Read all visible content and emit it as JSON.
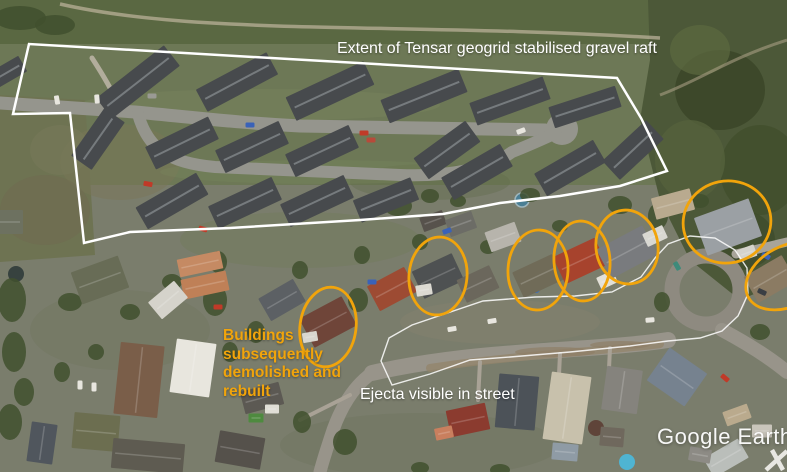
{
  "watermark": {
    "text": "Google Earth"
  },
  "annotations": {
    "colors": {
      "orange": "#F1A40B",
      "white": "#FFFFFF"
    },
    "geogrid": {
      "label": "Extent of Tensar geogrid stabilised gravel raft",
      "points": "29,44 13,114 70,113 84,243 130,232 230,228 360,220 443,214 500,203 560,196 620,186 667,171 641,118 617,78"
    },
    "ejecta": {
      "label": "Ejecta visible in street",
      "points": "381,361 389,338 412,325 483,301 535,297 575,296 612,292 641,277 655,258 668,244 690,236 715,238 735,250 747,268 748,294 738,316 722,331 700,338 668,341 630,346 570,352 510,357 470,360 430,374 392,385"
    },
    "demolished": {
      "lines": [
        "Buildings",
        "subsequently",
        "demolished and",
        "rebuilt"
      ],
      "ellipses": [
        {
          "cx": 328,
          "cy": 327,
          "rx": 28,
          "ry": 40,
          "rot": 8
        },
        {
          "cx": 438,
          "cy": 276,
          "rx": 29,
          "ry": 39,
          "rot": 5
        },
        {
          "cx": 538,
          "cy": 270,
          "rx": 30,
          "ry": 40,
          "rot": 3
        },
        {
          "cx": 582,
          "cy": 261,
          "rx": 28,
          "ry": 40,
          "rot": -4
        },
        {
          "cx": 627,
          "cy": 247,
          "rx": 31,
          "ry": 37,
          "rot": -8
        },
        {
          "cx": 727,
          "cy": 222,
          "rx": 44,
          "ry": 41,
          "rot": -12
        },
        {
          "cx": 788,
          "cy": 276,
          "rx": 45,
          "ry": 30,
          "rot": -28
        }
      ]
    }
  },
  "scene": {
    "subdivision_buildings": [
      [
        138,
        82,
        86,
        26,
        -38
      ],
      [
        237,
        82,
        80,
        25,
        -28
      ],
      [
        330,
        91,
        86,
        26,
        -25
      ],
      [
        424,
        96,
        84,
        25,
        -22
      ],
      [
        510,
        101,
        78,
        24,
        -20
      ],
      [
        585,
        107,
        70,
        22,
        -18
      ],
      [
        8,
        72,
        34,
        18,
        -30
      ],
      [
        98,
        139,
        58,
        25,
        -55
      ],
      [
        182,
        143,
        70,
        25,
        -26
      ],
      [
        252,
        147,
        70,
        25,
        -25
      ],
      [
        322,
        151,
        70,
        25,
        -25
      ],
      [
        447,
        150,
        64,
        26,
        -36
      ],
      [
        172,
        201,
        70,
        25,
        -30
      ],
      [
        245,
        203,
        70,
        25,
        -25
      ],
      [
        317,
        201,
        70,
        25,
        -25
      ],
      [
        386,
        200,
        62,
        24,
        -22
      ],
      [
        477,
        172,
        68,
        26,
        -30
      ],
      [
        570,
        168,
        68,
        26,
        -30
      ],
      [
        633,
        150,
        60,
        26,
        -43
      ]
    ],
    "suburb_buildings": [
      [
        8,
        222,
        30,
        24,
        0,
        "#6d7160"
      ],
      [
        100,
        280,
        50,
        34,
        -20,
        "#686c56"
      ],
      [
        200,
        264,
        44,
        18,
        -12,
        "#c58a63"
      ],
      [
        205,
        285,
        46,
        20,
        -12,
        "#bf8057"
      ],
      [
        168,
        300,
        34,
        22,
        -40,
        "#d5d3cb"
      ],
      [
        282,
        300,
        40,
        26,
        -30,
        "#5c6064"
      ],
      [
        328,
        322,
        48,
        33,
        -28,
        "#6f4539"
      ],
      [
        310,
        337,
        15,
        10,
        -10,
        "#d8d6ce"
      ],
      [
        392,
        289,
        42,
        28,
        -28,
        "#9d4b33"
      ],
      [
        433,
        221,
        24,
        15,
        -20,
        "#57524c"
      ],
      [
        461,
        224,
        28,
        18,
        -20,
        "#6c6c66"
      ],
      [
        503,
        237,
        32,
        21,
        -20,
        "#b7b4ac"
      ],
      [
        438,
        276,
        44,
        30,
        -25,
        "#4e5152"
      ],
      [
        424,
        290,
        16,
        11,
        -10,
        "#dcdad2"
      ],
      [
        478,
        284,
        36,
        25,
        -25,
        "#6b675c"
      ],
      [
        538,
        276,
        44,
        28,
        -25,
        "#706b58"
      ],
      [
        580,
        261,
        46,
        30,
        -25,
        "#a7432d"
      ],
      [
        607,
        280,
        18,
        13,
        -25,
        "#e2e0d8"
      ],
      [
        627,
        252,
        52,
        33,
        -28,
        "#797b7e"
      ],
      [
        655,
        236,
        22,
        14,
        -25,
        "#d9d8d2"
      ],
      [
        673,
        204,
        40,
        22,
        -15,
        "#b9aa8f"
      ],
      [
        728,
        227,
        58,
        40,
        -20,
        "#9ba0a4"
      ],
      [
        747,
        253,
        18,
        12,
        -20,
        "#d5d3cb"
      ],
      [
        770,
        279,
        44,
        30,
        -30,
        "#8b7b63"
      ],
      [
        139,
        380,
        44,
        72,
        6,
        "#7a5e49"
      ],
      [
        193,
        368,
        40,
        54,
        8,
        "#e8e6de"
      ],
      [
        96,
        432,
        46,
        36,
        5,
        "#6c6e50"
      ],
      [
        42,
        443,
        26,
        40,
        8,
        "#50565d"
      ],
      [
        148,
        456,
        72,
        30,
        5,
        "#5e5b51"
      ],
      [
        240,
        450,
        46,
        32,
        10,
        "#55514b"
      ],
      [
        262,
        398,
        40,
        23,
        -15,
        "#5c5953"
      ],
      [
        272,
        409,
        14,
        9,
        0,
        "#e0ded6"
      ],
      [
        256,
        418,
        15,
        9,
        0,
        "#4e8a3f"
      ],
      [
        468,
        420,
        40,
        27,
        -12,
        "#8b3b2f"
      ],
      [
        444,
        433,
        18,
        12,
        -12,
        "#c97f5e"
      ],
      [
        517,
        402,
        40,
        54,
        5,
        "#4c5258"
      ],
      [
        567,
        408,
        40,
        68,
        8,
        "#c8c1ac"
      ],
      [
        565,
        452,
        26,
        17,
        5,
        "#8f9ba5"
      ],
      [
        622,
        390,
        36,
        44,
        8,
        "#85837d"
      ],
      [
        612,
        437,
        24,
        19,
        5,
        "#6f685d"
      ],
      [
        677,
        377,
        46,
        40,
        35,
        "#76828f"
      ],
      [
        726,
        458,
        40,
        22,
        -30,
        "#babeba"
      ],
      [
        762,
        431,
        20,
        13,
        0,
        "#c9c5bb"
      ],
      [
        737,
        415,
        26,
        15,
        -20,
        "#baaa8d"
      ],
      [
        700,
        455,
        22,
        14,
        10,
        "#8d8b85"
      ]
    ],
    "trees": [
      [
        20,
        18,
        26,
        12
      ],
      [
        55,
        25,
        20,
        10
      ],
      [
        12,
        300,
        14,
        22
      ],
      [
        14,
        352,
        12,
        20
      ],
      [
        10,
        422,
        12,
        18
      ],
      [
        24,
        392,
        10,
        14
      ],
      [
        70,
        302,
        12,
        9
      ],
      [
        130,
        312,
        10,
        8
      ],
      [
        96,
        352,
        8,
        8
      ],
      [
        62,
        372,
        8,
        10
      ],
      [
        172,
        282,
        10,
        8
      ],
      [
        215,
        300,
        12,
        16
      ],
      [
        218,
        262,
        9,
        11
      ],
      [
        256,
        332,
        9,
        11
      ],
      [
        300,
        270,
        8,
        9
      ],
      [
        358,
        300,
        10,
        12
      ],
      [
        362,
        255,
        8,
        9
      ],
      [
        398,
        206,
        14,
        10
      ],
      [
        430,
        196,
        9,
        7
      ],
      [
        458,
        201,
        8,
        6
      ],
      [
        488,
        247,
        8,
        7
      ],
      [
        530,
        195,
        10,
        7
      ],
      [
        560,
        226,
        8,
        6
      ],
      [
        620,
        205,
        12,
        9
      ],
      [
        658,
        216,
        10,
        13
      ],
      [
        700,
        201,
        9,
        7
      ],
      [
        662,
        302,
        8,
        10
      ],
      [
        760,
        332,
        10,
        8
      ],
      [
        345,
        442,
        12,
        13
      ],
      [
        302,
        422,
        9,
        11
      ],
      [
        230,
        352,
        8,
        10
      ],
      [
        420,
        242,
        8,
        8
      ],
      [
        500,
        470,
        10,
        6
      ],
      [
        420,
        468,
        9,
        6
      ],
      [
        596,
        428,
        8,
        8,
        "#5a3a30"
      ]
    ],
    "cars": [
      [
        57,
        100,
        80,
        "#e8e6df"
      ],
      [
        97,
        99,
        85,
        "#e8e6df"
      ],
      [
        152,
        96,
        0,
        "#9a9a94"
      ],
      [
        148,
        184,
        10,
        "#c03a28"
      ],
      [
        203,
        229,
        15,
        "#c03a28"
      ],
      [
        250,
        125,
        0,
        "#3a62b8"
      ],
      [
        364,
        133,
        0,
        "#c03a28"
      ],
      [
        371,
        140,
        0,
        "#b84a3a"
      ],
      [
        521,
        131,
        -20,
        "#e8e6df"
      ],
      [
        372,
        282,
        0,
        "#3a62b8"
      ],
      [
        218,
        307,
        0,
        "#c03a28"
      ],
      [
        447,
        231,
        -20,
        "#3a62b8"
      ],
      [
        80,
        385,
        90,
        "#e8e6df"
      ],
      [
        94,
        387,
        90,
        "#e8e6df"
      ],
      [
        452,
        329,
        -10,
        "#e8e6df"
      ],
      [
        492,
        321,
        -10,
        "#e8e6df"
      ],
      [
        650,
        320,
        -5,
        "#e8e6df"
      ],
      [
        677,
        266,
        60,
        "#3e8a7a"
      ],
      [
        762,
        292,
        25,
        "#3b3f44"
      ],
      [
        766,
        256,
        30,
        "#3a62b8"
      ],
      [
        725,
        378,
        40,
        "#c03a28"
      ]
    ]
  }
}
